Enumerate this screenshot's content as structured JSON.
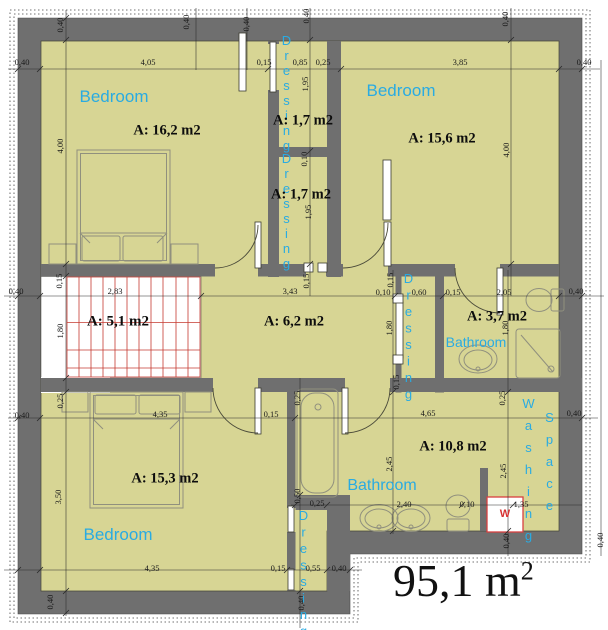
{
  "plan": {
    "total": {
      "value": "95,1 m",
      "sup": "2"
    },
    "rooms": {
      "bedroom_top_left": {
        "name": "Bedroom",
        "area": "A: 16,2 m2"
      },
      "dressing_upper": {
        "name": "Dressing",
        "area": "A: 1,7 m2"
      },
      "dressing_lower": {
        "name": "Dressing",
        "area": "A: 1,7 m2"
      },
      "bedroom_top_right": {
        "name": "Bedroom",
        "area": "A: 15,6 m2"
      },
      "stairwell": {
        "area": "A: 5,1 m2"
      },
      "hallway": {
        "area": "A: 6,2 m2"
      },
      "dressing_mid": {
        "name": "Dressing"
      },
      "bathroom_upper": {
        "name": "Bathroom",
        "area": "A: 3,7 m2"
      },
      "bedroom_bottom": {
        "name": "Bedroom",
        "area": "A: 15,3 m2"
      },
      "bathroom_lower": {
        "name": "Bathroom"
      },
      "utility": {
        "area": "A: 10,8 m2"
      },
      "washing_space": {
        "word1": "Washing",
        "word2": "Space"
      },
      "dressing_bottom": {
        "name": "Dressing"
      }
    },
    "washer": {
      "label": "W"
    },
    "colors": {
      "floor": "#d7d594",
      "wall": "#6f6f6f",
      "label_blue": "#29abe2",
      "stairs_red": "#c53b32",
      "washer_red": "#d63131"
    },
    "dims": [
      "0,40",
      "4,05",
      "0,15",
      "0,85",
      "0,25",
      "3,85",
      "0,40",
      "0,40",
      "0,40",
      "0,40",
      "0,40",
      "0,40",
      "4,00",
      "4,00",
      "1,95",
      "0,10",
      "1,95",
      "0,40",
      "2,83",
      "3,43",
      "0,10",
      "0,60",
      "0,15",
      "2,05",
      "0,40",
      "0,15",
      "0,15",
      "0,15",
      "1,80",
      "1,80",
      "1,80",
      "0,15",
      "0,40",
      "4,35",
      "0,15",
      "4,65",
      "0,40",
      "0,25",
      "0,25",
      "0,25",
      "3,50",
      "2,45",
      "2,45",
      "0,25",
      "2,40",
      "0,10",
      "1,35",
      "0,50",
      "4,35",
      "0,15",
      "0,55",
      "0,40",
      "0,40",
      "0,40",
      "0,40",
      "0,40"
    ]
  }
}
